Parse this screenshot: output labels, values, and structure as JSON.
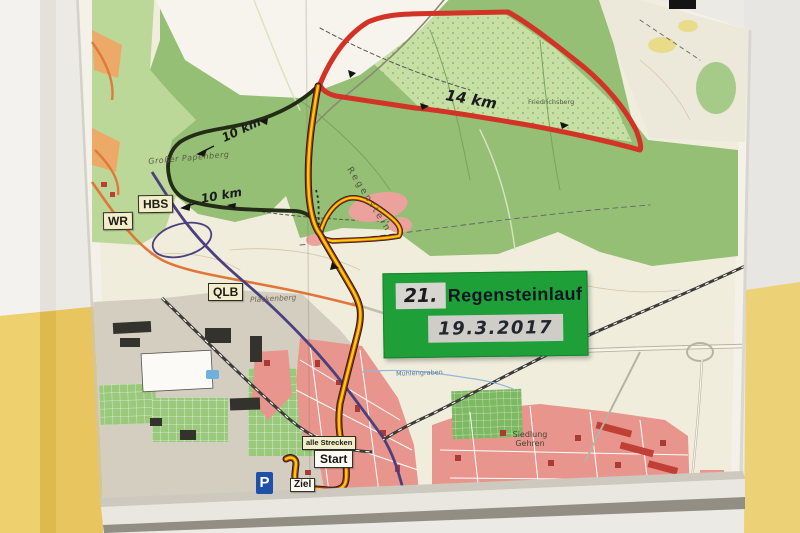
{
  "sign": {
    "number": "21.",
    "title": "Regensteinlauf",
    "date": "19.3.2017",
    "bg_color": "#1f9f38"
  },
  "station_markers": {
    "hbs": "HBS",
    "wr": "WR",
    "qlb": "QLB"
  },
  "course_markers": {
    "all_tracks": "alle Strecken",
    "start": "Start",
    "finish": "Ziel",
    "parking": "P"
  },
  "route_labels": {
    "red": "14 km",
    "black_upper": "10 km",
    "black_lower": "10 km"
  },
  "routes": {
    "red_course": {
      "distance": "14 km",
      "color": "#d23326"
    },
    "black_course": {
      "distance": "10 km",
      "color": "#232c16"
    },
    "all_courses": {
      "label": "alle Strecken",
      "color": "#f2cf00"
    }
  },
  "place_names": {
    "papenberg": "Großer Papenberg",
    "regenstein": "Regenstein",
    "plackenberg": "Plackenberg",
    "siedlung_gehren": "Siedlung Gehren",
    "friedrichsberg": "Friedrichsberg",
    "muehlengraben": "Mühlengraben"
  },
  "colors": {
    "wall_white": "#eceae5",
    "wall_yellow": "#e8c55e",
    "forest_green": "#94bf74",
    "open_field": "#f1eddd",
    "town_pink": "#e8958d",
    "road_purple": "#4a4080",
    "road_orange": "#e0763a"
  }
}
